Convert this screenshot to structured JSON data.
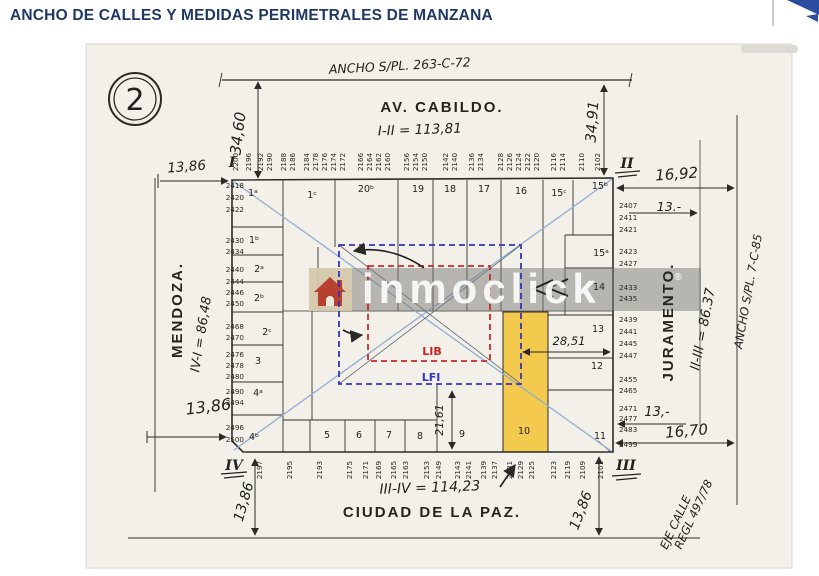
{
  "header": {
    "title": "ANCHO DE CALLES Y MEDIDAS PERIMETRALES DE MANZANA"
  },
  "watermark": {
    "text": "inmoclick",
    "reg": "®"
  },
  "plan": {
    "sheet_number": "2",
    "streets": {
      "top": {
        "name": "AV. CABILDO.",
        "segment": "I-II = 113,81",
        "width_note": "ANCHO S/PL. 263-C-72"
      },
      "left": {
        "name": "MENDOZA.",
        "segment": "IV-I = 86,48"
      },
      "right": {
        "name": "JURAMENTO.",
        "segment": "II-III = 86.37",
        "width_note": "ANCHO S/PL. 7-C-85"
      },
      "bottom": {
        "name": "CIUDAD DE LA PAZ.",
        "segment": "III-IV = 114,23",
        "axis_note": [
          "EJE CALLE",
          "REGL 497/78"
        ]
      }
    },
    "corner_markers": {
      "tl": "I",
      "tr": "II",
      "br": "III",
      "bl": "IV"
    },
    "zones": {
      "inner": "LIB",
      "outer": "LFI"
    },
    "dimensions": {
      "corner_tl_offset": "13,86",
      "av_cabildo_width_left": "34,60",
      "av_cabildo_width_right": "34,91",
      "corner_tr_offset": "16,92",
      "lot_depth_juramento_top": "13.-",
      "lot_depth_juramento_bottom": "13,-",
      "corner_br_offset": "16,70",
      "corner_bl_offset": "13,86",
      "street_half_width_bl": "13,86",
      "street_half_width_br": "13,86",
      "center_to_block_edge": "28,51",
      "lfi_to_block_edge": "21,61"
    },
    "lots": {
      "top": [
        {
          "n": "1ᵃ",
          "x": 253,
          "y": 196
        },
        {
          "n": "1ᶜ",
          "x": 312,
          "y": 198
        },
        {
          "n": "20ᵇ",
          "x": 366,
          "y": 192
        },
        {
          "n": "19",
          "x": 418,
          "y": 192
        },
        {
          "n": "18",
          "x": 450,
          "y": 192
        },
        {
          "n": "17",
          "x": 484,
          "y": 192
        },
        {
          "n": "16",
          "x": 521,
          "y": 194
        },
        {
          "n": "15ᶜ",
          "x": 559,
          "y": 196
        },
        {
          "n": "15ᵇ",
          "x": 600,
          "y": 189
        }
      ],
      "left": [
        {
          "n": "1ᵇ",
          "x": 254,
          "y": 243
        },
        {
          "n": "2ᵃ",
          "x": 259,
          "y": 272
        },
        {
          "n": "2ᵇ",
          "x": 259,
          "y": 301
        },
        {
          "n": "2ᶜ",
          "x": 267,
          "y": 335
        },
        {
          "n": "3",
          "x": 258,
          "y": 364
        },
        {
          "n": "4ᵃ",
          "x": 258,
          "y": 396
        },
        {
          "n": "4ᵇ",
          "x": 254,
          "y": 440
        }
      ],
      "right": [
        {
          "n": "15ᵃ",
          "x": 601,
          "y": 256
        },
        {
          "n": "14",
          "x": 599,
          "y": 290
        },
        {
          "n": "13",
          "x": 598,
          "y": 332
        },
        {
          "n": "12",
          "x": 597,
          "y": 369
        }
      ],
      "bottom": [
        {
          "n": "5",
          "x": 327,
          "y": 438
        },
        {
          "n": "6",
          "x": 359,
          "y": 438
        },
        {
          "n": "7",
          "x": 389,
          "y": 438
        },
        {
          "n": "8",
          "x": 420,
          "y": 439
        },
        {
          "n": "9",
          "x": 462,
          "y": 437
        },
        {
          "n": "10",
          "x": 524,
          "y": 434
        },
        {
          "n": "11",
          "x": 600,
          "y": 439
        }
      ]
    },
    "house_numbers": {
      "av_cabildo_top": [
        "2200",
        "2196",
        "2192",
        "2190",
        "2188",
        "2186",
        "2184",
        "2178",
        "2176",
        "2174",
        "2172",
        "2166",
        "2164",
        "2162",
        "2160",
        "2156",
        "2154",
        "2150",
        "2142",
        "2140",
        "2136",
        "2134",
        "2128",
        "2126",
        "2124",
        "2122",
        "2120",
        "2116",
        "2114",
        "2110",
        "2102"
      ],
      "mendoza_left": [
        "2418",
        "2420",
        "2422",
        "2430",
        "2434",
        "2440",
        "2444",
        "2446",
        "2450",
        "2468",
        "2470",
        "2476",
        "2478",
        "2480",
        "2490",
        "2494",
        "2496",
        "2500"
      ],
      "juramento_right": [
        "2407",
        "2411",
        "2421",
        "2423",
        "2427",
        "2433",
        "2435",
        "2439",
        "2441",
        "2445",
        "2447",
        "2455",
        "2465",
        "2471",
        "2477",
        "2483",
        "2499"
      ],
      "ciudad_de_la_paz_bottom": [
        "2197",
        "2195",
        "2193",
        "2175",
        "2171",
        "2169",
        "2165",
        "2163",
        "2153",
        "2149",
        "2143",
        "2141",
        "2139",
        "2137",
        "2131",
        "2129",
        "2125",
        "2123",
        "2119",
        "2109",
        "2101"
      ]
    },
    "colors": {
      "highlight_lot": "#F3C73F",
      "lfi_line": "#3434C0",
      "lib_line": "#C62B2B",
      "diagonal": "#93ADD1",
      "title_text": "#1F3864",
      "logo": "#2A4DA0",
      "paper": "#F2F0E9"
    }
  },
  "stamps": [
    {
      "p": "plan.sheet_number",
      "x": 135,
      "y": 110,
      "s": 30,
      "k": "lot",
      "name": "sheet-number"
    },
    {
      "p": "plan.streets.top.width_note",
      "x": 400,
      "y": 70,
      "s": 12.5,
      "k": "hand",
      "r": -3,
      "name": "street-width-note-top"
    },
    {
      "p": "plan.streets.top.name",
      "x": 442,
      "y": 112,
      "s": 15,
      "k": "print",
      "name": "street-name-top"
    },
    {
      "p": "plan.streets.top.segment",
      "x": 420,
      "y": 134,
      "s": 13.5,
      "k": "hand",
      "r": -2,
      "name": "segment-length-top"
    },
    {
      "p": "plan.streets.left.name",
      "x": 182,
      "y": 310,
      "s": 15,
      "k": "print",
      "r": -90,
      "name": "street-name-left"
    },
    {
      "p": "plan.streets.left.segment",
      "x": 205,
      "y": 335,
      "s": 13,
      "k": "hand",
      "r": -81,
      "name": "segment-length-left"
    },
    {
      "p": "plan.streets.right.name",
      "x": 673,
      "y": 322,
      "s": 15,
      "k": "print",
      "r": -90,
      "name": "street-name-right"
    },
    {
      "p": "plan.streets.right.segment",
      "x": 707,
      "y": 330,
      "s": 13.5,
      "k": "hand",
      "r": -79,
      "name": "segment-length-right"
    },
    {
      "p": "plan.streets.right.width_note",
      "x": 752,
      "y": 292,
      "s": 11.5,
      "k": "hand",
      "r": -80,
      "name": "street-width-note-right"
    },
    {
      "p": "plan.streets.bottom.segment",
      "x": 430,
      "y": 492,
      "s": 14,
      "k": "hand",
      "r": -2,
      "name": "segment-length-bottom"
    },
    {
      "p": "plan.streets.bottom.name",
      "x": 432,
      "y": 517,
      "s": 15,
      "k": "print",
      "name": "street-name-bottom"
    },
    {
      "p": "plan.streets.bottom.axis_note.0",
      "x": 679,
      "y": 524,
      "s": 11.5,
      "k": "hand",
      "r": -65,
      "name": "street-axis-note"
    },
    {
      "p": "plan.streets.bottom.axis_note.1",
      "x": 697,
      "y": 516,
      "s": 11.5,
      "k": "hand",
      "r": -65,
      "name": "street-axis-note"
    },
    {
      "p": "plan.dimensions.corner_tl_offset",
      "x": 187,
      "y": 171,
      "s": 13.5,
      "k": "hand",
      "r": -5,
      "name": "dimension-label"
    },
    {
      "p": "plan.dimensions.av_cabildo_width_left",
      "x": 243,
      "y": 134,
      "s": 15,
      "k": "hand",
      "r": -83,
      "name": "dimension-label"
    },
    {
      "p": "plan.dimensions.av_cabildo_width_right",
      "x": 597,
      "y": 122,
      "s": 14.5,
      "k": "hand",
      "r": -86,
      "name": "dimension-label"
    },
    {
      "p": "plan.dimensions.corner_tr_offset",
      "x": 677,
      "y": 179,
      "s": 15,
      "k": "hand",
      "r": -4,
      "name": "dimension-label"
    },
    {
      "p": "plan.dimensions.lot_depth_juramento_top",
      "x": 669,
      "y": 211,
      "s": 12.5,
      "k": "hand",
      "name": "dimension-label"
    },
    {
      "p": "plan.dimensions.lot_depth_juramento_bottom",
      "x": 657,
      "y": 416,
      "s": 13,
      "k": "hand",
      "name": "dimension-label"
    },
    {
      "p": "plan.dimensions.corner_br_offset",
      "x": 687,
      "y": 436,
      "s": 15,
      "k": "hand",
      "r": -5,
      "name": "dimension-label"
    },
    {
      "p": "plan.dimensions.corner_bl_offset",
      "x": 209,
      "y": 412,
      "s": 16,
      "k": "hand",
      "r": -7,
      "name": "dimension-label"
    },
    {
      "p": "plan.dimensions.street_half_width_bl",
      "x": 248,
      "y": 503,
      "s": 14,
      "k": "hand",
      "r": -74,
      "name": "dimension-label"
    },
    {
      "p": "plan.dimensions.street_half_width_br",
      "x": 585,
      "y": 512,
      "s": 14,
      "k": "hand",
      "r": -69,
      "name": "dimension-label"
    },
    {
      "p": "plan.dimensions.center_to_block_edge",
      "x": 569,
      "y": 345,
      "s": 11.5,
      "k": "hand",
      "name": "dimension-label"
    },
    {
      "p": "plan.dimensions.lfi_to_block_edge",
      "x": 443,
      "y": 420,
      "s": 11,
      "k": "hand",
      "r": -90,
      "name": "dimension-label"
    },
    {
      "p": "plan.corner_markers.tl",
      "x": 232,
      "y": 167,
      "s": 14,
      "k": "serif",
      "name": "corner-marker"
    },
    {
      "p": "plan.corner_markers.tr",
      "x": 627,
      "y": 168,
      "s": 14,
      "k": "serif",
      "name": "corner-marker"
    },
    {
      "p": "plan.corner_markers.br",
      "x": 626,
      "y": 470,
      "s": 14,
      "k": "serif",
      "name": "corner-marker"
    },
    {
      "p": "plan.corner_markers.bl",
      "x": 234,
      "y": 470,
      "s": 14,
      "k": "serif",
      "name": "corner-marker"
    },
    {
      "p": "plan.zones.inner",
      "x": 432,
      "y": 355,
      "s": 11,
      "k": "zl",
      "name": "zone-label-lib"
    },
    {
      "p": "plan.zones.outer",
      "x": 431,
      "y": 381,
      "s": 11,
      "k": "zf",
      "name": "zone-label-lfi"
    },
    {
      "p": "watermark.text",
      "x": 362,
      "y": 303,
      "s": 42,
      "k": "wm",
      "a": "s",
      "name": "watermark-text"
    },
    {
      "p": "watermark.reg",
      "x": 678,
      "y": 280,
      "s": 10,
      "k": "wms",
      "name": "watermark-reg"
    },
    {
      "arr": "plan.house_numbers.av_cabildo_top",
      "xs": [
        238,
        251,
        263,
        272,
        286,
        295,
        309,
        318,
        327,
        336,
        345,
        363,
        372,
        381,
        390,
        409,
        418,
        427,
        448,
        457,
        474,
        483,
        503,
        512,
        521,
        530,
        539,
        556,
        565,
        584,
        600
      ],
      "y": 162,
      "r": -90,
      "s": 7.2,
      "k": "num",
      "name": "house-number"
    },
    {
      "arr": "plan.house_numbers.ciudad_de_la_paz_bottom",
      "xs": [
        262,
        292,
        322,
        352,
        368,
        381,
        396,
        408,
        429,
        441,
        460,
        471,
        486,
        497,
        512,
        523,
        534,
        556,
        570,
        585,
        603
      ],
      "y": 470,
      "r": -90,
      "s": 7.2,
      "k": "num",
      "name": "house-number"
    },
    {
      "arr": "plan.house_numbers.mendoza_left",
      "ys": [
        188,
        200,
        212,
        243,
        254,
        272,
        284,
        295,
        306,
        329,
        340,
        357,
        368,
        379,
        394,
        405,
        430,
        442
      ],
      "x": 244,
      "a": "e",
      "s": 7.2,
      "k": "num",
      "name": "house-number"
    },
    {
      "arr": "plan.house_numbers.juramento_right",
      "ys": [
        208,
        220,
        232,
        254,
        266,
        290,
        301,
        322,
        334,
        346,
        358,
        382,
        393,
        411,
        421,
        432,
        447
      ],
      "x": 619,
      "a": "s",
      "s": 7.2,
      "k": "num",
      "name": "house-number"
    },
    {
      "arr": "plan.lots.top",
      "s": 9.5,
      "k": "lot",
      "name": "lot-number"
    },
    {
      "arr": "plan.lots.left",
      "s": 9.5,
      "k": "lot",
      "name": "lot-number"
    },
    {
      "arr": "plan.lots.right",
      "s": 9.5,
      "k": "lot",
      "name": "lot-number"
    },
    {
      "arr": "plan.lots.bottom",
      "s": 9.5,
      "k": "lot",
      "name": "lot-number"
    }
  ]
}
